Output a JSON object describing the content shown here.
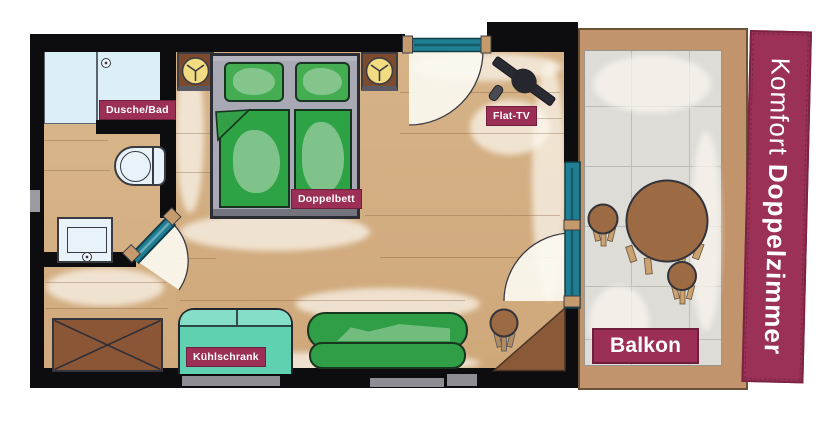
{
  "banner": {
    "text_regular": "Komfort ",
    "text_bold": "Doppelzimmer"
  },
  "room_labels": {
    "shower_bath": "Dusche/Bad",
    "double_bed": "Doppelbett",
    "flat_tv": "Flat-TV",
    "fridge": "Kühlschrank",
    "balcony": "Balkon"
  },
  "furniture": [
    "shower",
    "toilet",
    "sink",
    "bathroom-door",
    "double-bed",
    "nightstand-left",
    "nightstand-right",
    "bedside-lamps",
    "entry-door",
    "flat-tv",
    "tv-remote",
    "balcony-door",
    "wardrobe",
    "fridge",
    "sofa",
    "stool",
    "corner-table",
    "balcony-table",
    "balcony-stools"
  ],
  "colors": {
    "label_bg": "#9c2f55",
    "banner_bg": "#9c3157",
    "wall": "#0d0d0f",
    "floor_wood": "#d6b388",
    "shower_floor": "#dceef8",
    "bed_frame": "#a9a9b5",
    "bedding_green": "#2da345",
    "sofa_green": "#2f9e47",
    "fridge_teal": "#5fd1b0",
    "door_teal": "#207e93",
    "furniture_brown": "#8a5636",
    "balcony_wood": "#c2946c",
    "balcony_tile": "#dddcd7",
    "lamp_yellow": "#f2dc82"
  }
}
